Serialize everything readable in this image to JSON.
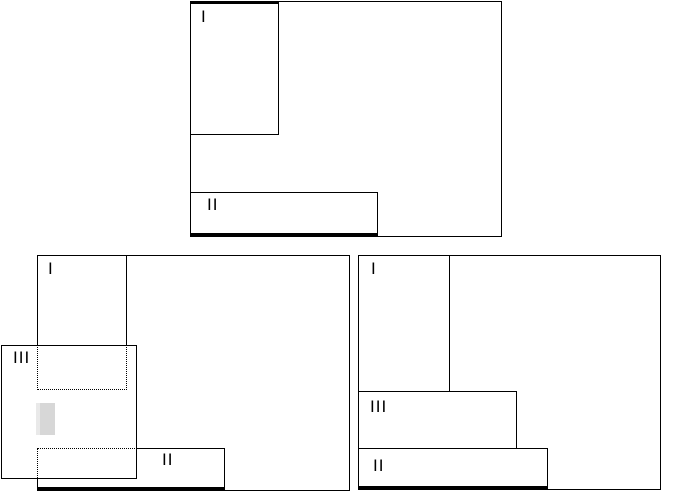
{
  "colors": {
    "line": "#000000",
    "background": "#ffffff",
    "gray_marker_fill": "#d7d7d7",
    "gray_marker_edge": "#e9e9e9"
  },
  "diagram_top": {
    "rect1_label": "I",
    "rect2_label": "II"
  },
  "diagram_bottom_left": {
    "rect1_label": "I",
    "rect2_label": "II",
    "rect3_label": "III"
  },
  "diagram_bottom_right": {
    "rect1_label": "I",
    "rect2_label": "II",
    "rect3_label": "III"
  }
}
